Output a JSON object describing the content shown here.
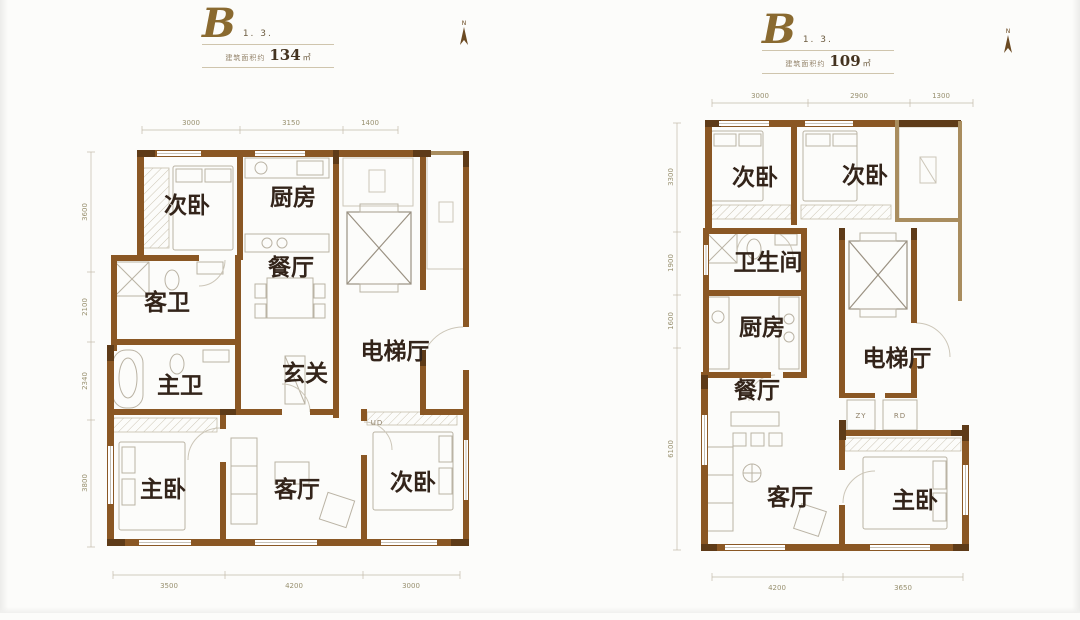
{
  "colors": {
    "wall": "#8a5724",
    "wall_dark": "#5e3b18",
    "label_text": "#33241a",
    "header_gold": "#8a6a30",
    "background": "#fcfcfa"
  },
  "plans": [
    {
      "name": "unit-b-134",
      "header": {
        "type_letter": "B",
        "sub_label": "1. 3.",
        "area_prefix": "建筑面积约",
        "area_value": "134",
        "area_unit": "㎡"
      },
      "north_label": "N",
      "rooms": {
        "bedroom_top": "次卧",
        "kitchen": "厨房",
        "dining": "餐厅",
        "guest_bath": "客卫",
        "master_bath": "主卫",
        "foyer": "玄关",
        "elevator_hall": "电梯厅",
        "master_bedroom": "主卧",
        "living": "客厅",
        "bedroom_bottom": "次卧"
      },
      "small_labels": {
        "entry_door": "UD"
      },
      "dims": {
        "top": [
          "3000",
          "3150",
          "1400"
        ],
        "bottom": [
          "3500",
          "4200",
          "3000"
        ],
        "left": [
          "3600",
          "2100",
          "2340",
          "3800"
        ]
      }
    },
    {
      "name": "unit-b-109",
      "header": {
        "type_letter": "B",
        "sub_label": "1. 3.",
        "area_prefix": "建筑面积约",
        "area_value": "109",
        "area_unit": "㎡"
      },
      "north_label": "N",
      "rooms": {
        "bedroom_left": "次卧",
        "bedroom_right": "次卧",
        "bathroom": "卫生间",
        "kitchen": "厨房",
        "dining": "餐厅",
        "elevator_hall": "电梯厅",
        "living": "客厅",
        "master_bedroom": "主卧"
      },
      "small_labels": {
        "shaft_zy": "ZY",
        "shaft_rd": "RD"
      },
      "dims": {
        "top": [
          "3000",
          "2900",
          "1300"
        ],
        "bottom": [
          "4200",
          "3650"
        ],
        "left": [
          "3300",
          "1900",
          "1600",
          "6100"
        ]
      }
    }
  ]
}
